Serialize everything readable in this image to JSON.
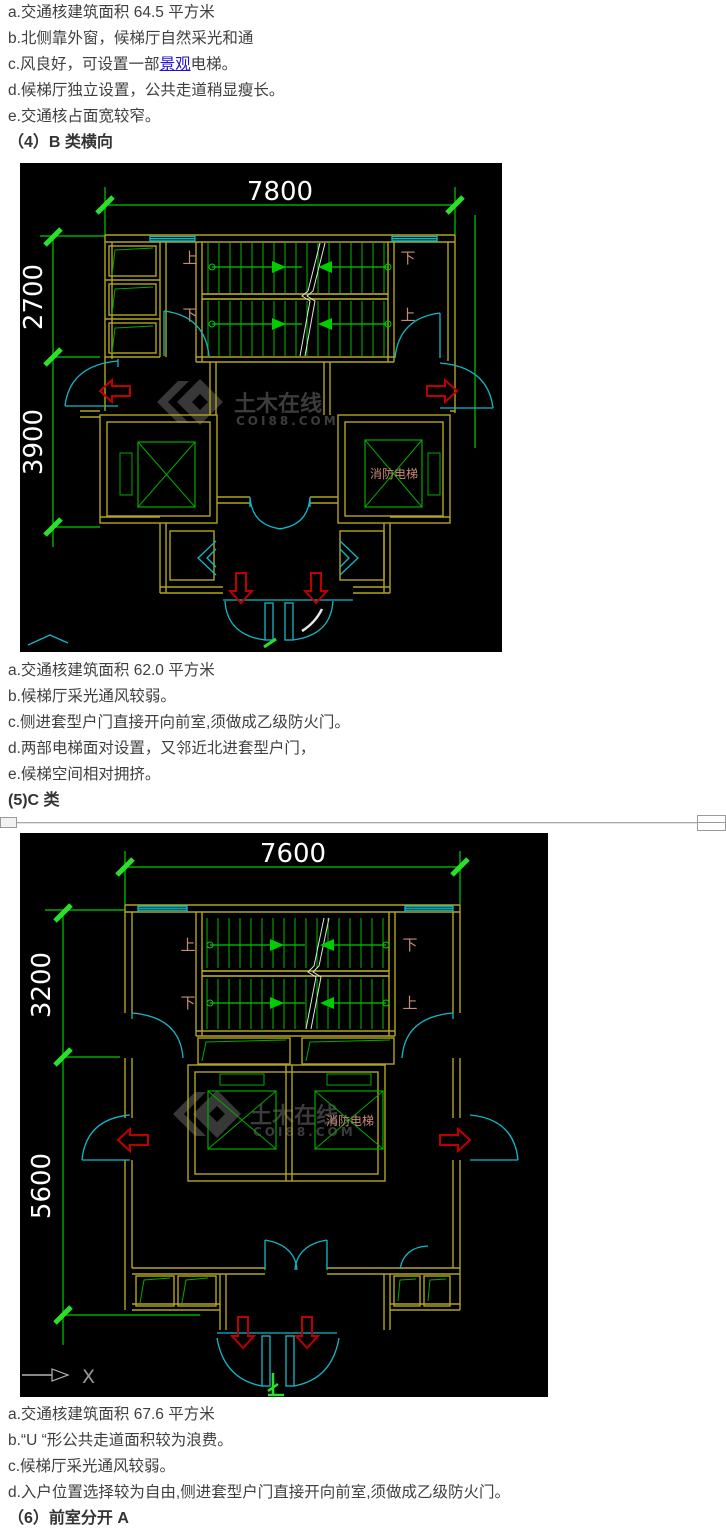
{
  "page": {
    "background": "#ffffff",
    "text_color": "#3f3f3f",
    "link_color": "#2212cc"
  },
  "cad_colors": {
    "background": "#000000",
    "line_green": "#00cc00",
    "tick_green": "#2ae02a",
    "wall_yellow": "#b3a51c",
    "door_cyan": "#12b8c8",
    "arrow_red": "#c00000",
    "label_salmon": "#c98b76",
    "dim_text": "#ffffff",
    "watermark_gray": "#3c3c3c",
    "axis_gray": "#a8a8a8"
  },
  "block1": {
    "line_a": "a.交通核建筑面积 64.5 平方米",
    "line_b": "b.北侧靠外窗，候梯厅自然采光和通",
    "line_c_pre": "c.风良好，可设置一部",
    "line_c_link": "景观",
    "line_c_post": "电梯。",
    "line_d": "d.候梯厅独立设置，公共走道稍显瘦长。",
    "line_e": "e.交通核占面宽较窄。",
    "heading": "（4）B 类横向"
  },
  "figure1": {
    "dim_width": "7800",
    "dim_upper": "2700",
    "dim_lower": "3900",
    "label_up": "上",
    "label_down": "下",
    "fire_elevator": "消防电梯",
    "watermark_title": "土木在线",
    "watermark_site": "COI88.COM"
  },
  "block2": {
    "line_a": "a.交通核建筑面积 62.0 平方米",
    "line_b": "b.候梯厅采光通风较弱。",
    "line_c": "c.侧进套型户门直接开向前室,须做成乙级防火门。",
    "line_d": "d.两部电梯面对设置，又邻近北进套型户门，",
    "line_e": "e.候梯空间相对拥挤。",
    "heading": "(5)C 类"
  },
  "figure2": {
    "dim_width": "7600",
    "dim_upper": "3200",
    "dim_lower": "5600",
    "label_up": "上",
    "label_down": "下",
    "fire_elevator": "消防电梯",
    "watermark_title": "土木在线",
    "watermark_site": "COI88.COM",
    "axis_x": "X"
  },
  "block3": {
    "line_a": "a.交通核建筑面积 67.6 平方米",
    "line_b": "b.“U “形公共走道面积较为浪费。",
    "line_c": "c.候梯厅采光通风较弱。",
    "line_d": "d.入户位置选择较为自由,侧进套型户门直接开向前室,须做成乙级防火门。",
    "heading": "（6）前室分开 A"
  }
}
